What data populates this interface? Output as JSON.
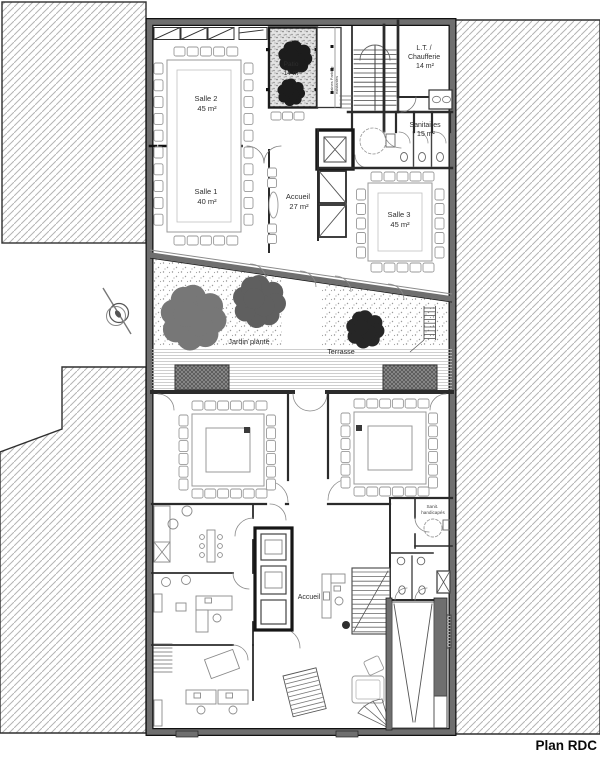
{
  "title": "Plan RDC",
  "colors": {
    "wall_gray": "#6f6f6f",
    "line_dark": "#1f1f1f",
    "hatch_gray": "#b4b4b4",
    "tree_dark": "#1c1c1c",
    "tree_gray": "#6e6e6e",
    "text": "#2e2e2e"
  },
  "rooms": {
    "salle2": {
      "name": "Salle 2",
      "area": "45 m²"
    },
    "salle1": {
      "name": "Salle 1",
      "area": "40 m²"
    },
    "patio": {
      "name": "Patio",
      "area": "14 m²"
    },
    "chaufferie": {
      "line1": "L.T. /",
      "line2": "Chaufferie",
      "area": "14 m²"
    },
    "sanitaires": {
      "name": "Sanitaires",
      "area": "15 m²"
    },
    "accueil": {
      "name": "Accueil",
      "area": "27 m²"
    },
    "salle3": {
      "name": "Salle 3",
      "area": "45 m²"
    },
    "jardin": {
      "name": "Jardin planté"
    },
    "terrasse": {
      "name": "Terrasse"
    },
    "gaines": {
      "line1": "Gaines Parking",
      "line2": "existantes"
    },
    "sanit_handicapes": {
      "line1": "Sanit.",
      "line2": "handicapés"
    },
    "accueil_bas": {
      "name": "Accueil"
    }
  }
}
